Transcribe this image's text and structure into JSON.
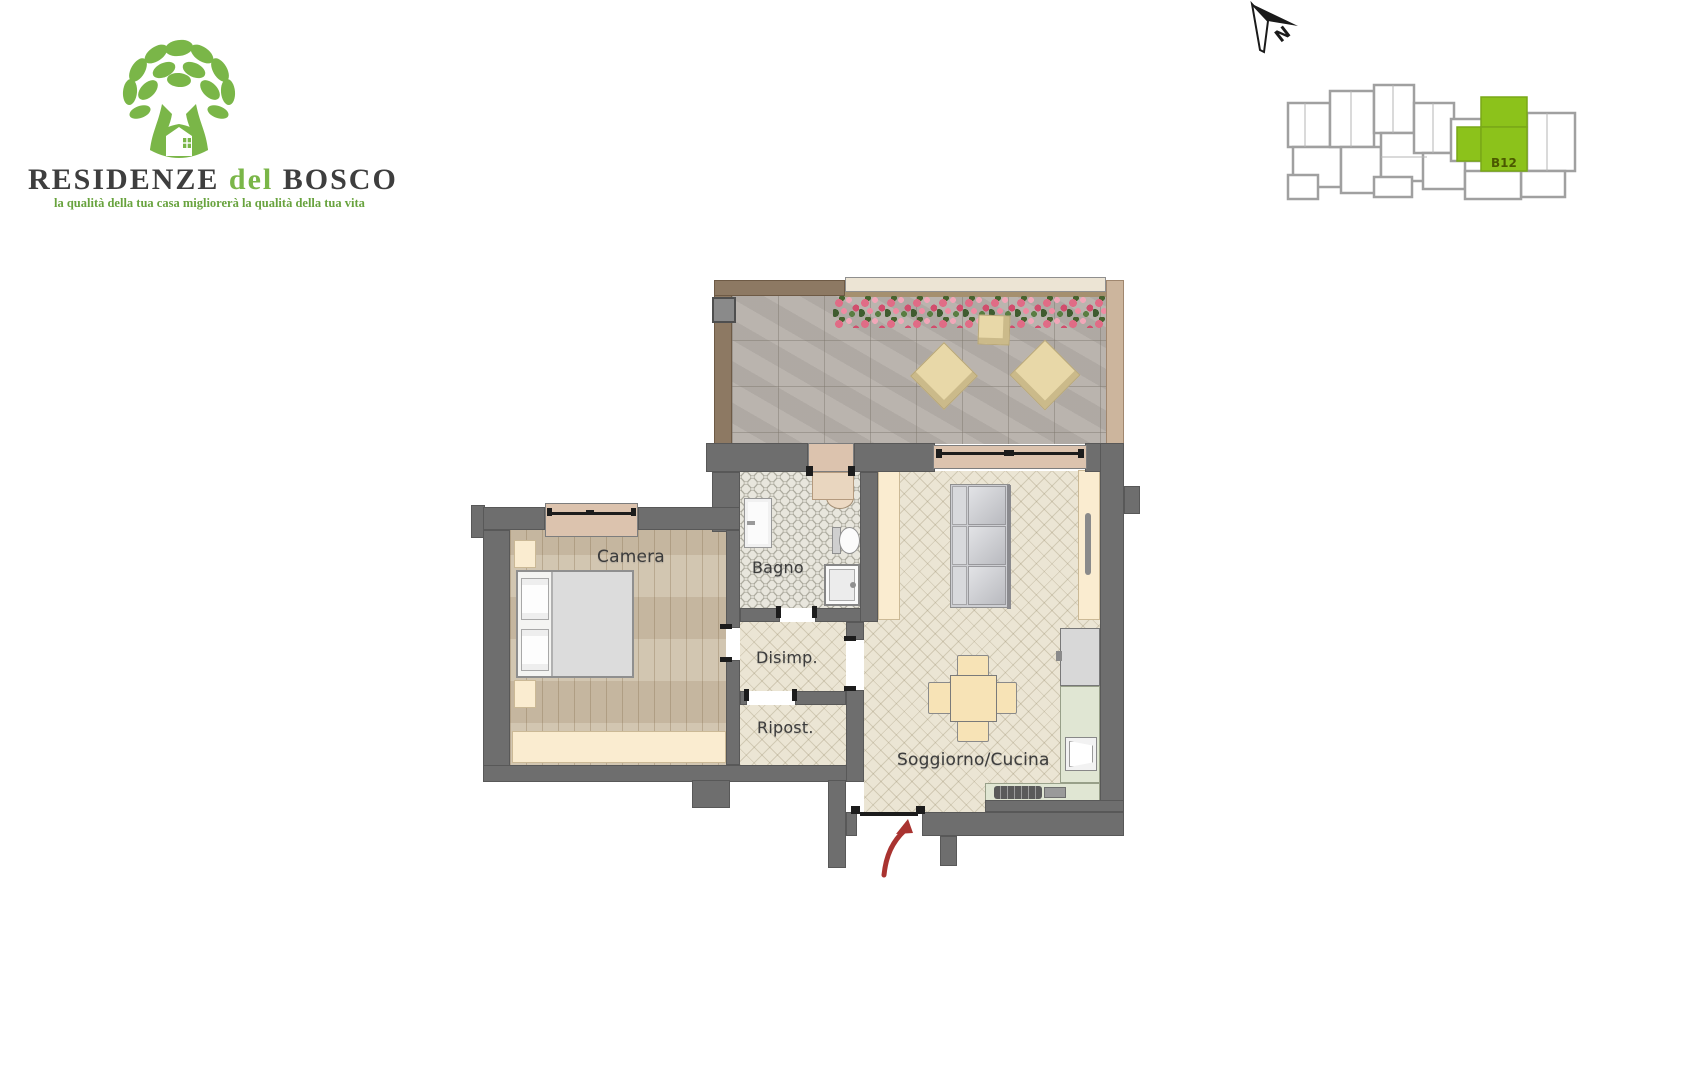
{
  "logo": {
    "brand_part1": "RESIDENZE",
    "brand_part2": "del",
    "brand_part3": "BOSCO",
    "tagline": "la qualità della tua casa migliorerà la qualità della tua vita",
    "green": "#7ab648",
    "dark": "#3e3e3e"
  },
  "north_indicator": {
    "label": "N"
  },
  "site_plan": {
    "unit_label": "B12",
    "highlight_color": "#8cc21b",
    "outline_color": "#a0a0a0",
    "label_color": "#4b5800"
  },
  "floor_plan": {
    "rooms": [
      {
        "id": "camera",
        "label": "Camera"
      },
      {
        "id": "bagno",
        "label": "Bagno"
      },
      {
        "id": "disimp",
        "label": "Disimp."
      },
      {
        "id": "ripost",
        "label": "Ripost."
      },
      {
        "id": "soggiorno",
        "label": "Soggiorno/Cucina"
      }
    ],
    "colors": {
      "wall": "#6e6e6e",
      "terrace_wall_brown": "#8d7963",
      "window_sill_tan": "#dcc3ae",
      "wood_floor": "#cdbfa8",
      "herringbone_floor": "#ebe5d4",
      "hex_tile_floor": "#e8e6dd",
      "terrace_tile": "#b6b0aa",
      "wardrobe_cream": "#faecd0",
      "kitchen_counter_green": "#e0e6d3",
      "entrance_arrow_red": "#a93330"
    }
  }
}
